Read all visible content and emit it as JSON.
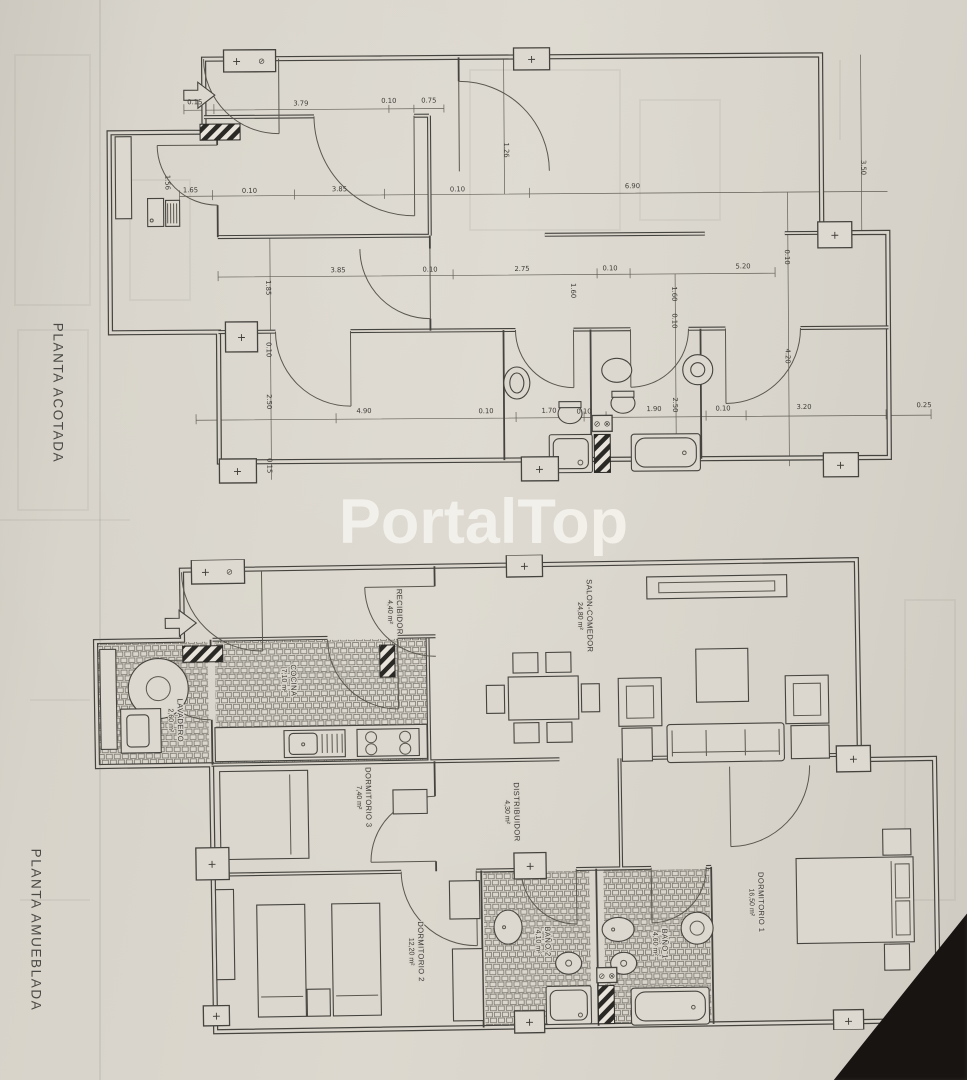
{
  "watermark": "PortalTop",
  "side_labels": {
    "top": "PLANTA ACOTADA",
    "bottom": "PLANTA AMUEBLADA"
  },
  "symbols": {
    "plus": "+",
    "slashed_circle": "⊘",
    "cross_circle": "⊗"
  },
  "colors": {
    "paper": "#d8d4cb",
    "ink": "#45433e",
    "watermark": "#f4f2ec",
    "shadow": "#181411"
  },
  "plan_acotada": {
    "dims_h": [
      "0.15",
      "3.79",
      "0.10",
      "0.75",
      "1.65",
      "0.10",
      "3.85",
      "0.10",
      "6.90",
      "3.85",
      "0.10",
      "2.75",
      "0.10",
      "5.20",
      "4.90",
      "0.10",
      "1.70",
      "0.10",
      "1.90",
      "0.10",
      "3.20",
      "0.25"
    ],
    "dims_v": [
      "1.26",
      "1.56",
      "3.50",
      "1.85",
      "0.10",
      "1.60",
      "1.60",
      "0.10",
      "4.20",
      "2.50",
      "2.50",
      "0.15",
      "0.10"
    ]
  },
  "plan_amueblada": {
    "rooms": [
      {
        "name": "RECIBIDOR",
        "area": "4,40 m²"
      },
      {
        "name": "COCINA",
        "area": "7,10 m²"
      },
      {
        "name": "LAVADERO",
        "area": "2,60 m²"
      },
      {
        "name": "SALON-COMEDOR",
        "area": "24,80 m²"
      },
      {
        "name": "DORMITORIO 3",
        "area": "7,40 m²"
      },
      {
        "name": "DISTRIBUIDOR",
        "area": "4,30 m²"
      },
      {
        "name": "DORMITORIO 2",
        "area": "12,20 m²"
      },
      {
        "name": "BAÑO 2",
        "area": "4,10 m²"
      },
      {
        "name": "BAÑO 1",
        "area": "4,60 m²"
      },
      {
        "name": "DORMITORIO 1",
        "area": "16,50 m²"
      }
    ]
  }
}
